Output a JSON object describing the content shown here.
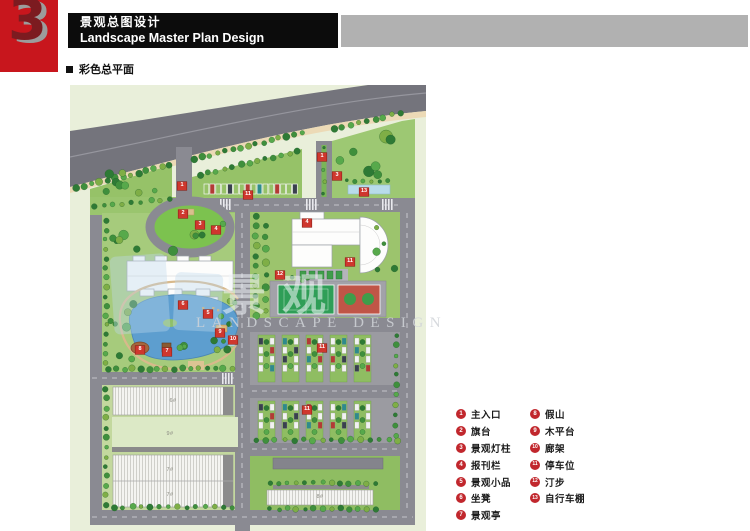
{
  "header": {
    "section_number": "3",
    "title_zh": "景观总图设计",
    "title_en": "Landscape Master Plan Design"
  },
  "subheader": {
    "label": "彩色总平面"
  },
  "watermark": {
    "text_zh": "景观",
    "text_en": "LANDSCAPE DESIGN"
  },
  "colors": {
    "accent_red": "#c8161d",
    "banner_black": "#0c0c0c",
    "bar_gray": "#b1b1b1",
    "marker_red": "#cf372e",
    "legend_red": "#c1272d"
  },
  "legend": {
    "columns": [
      {
        "items": [
          {
            "n": "1",
            "label": "主入口"
          },
          {
            "n": "2",
            "label": "旗台"
          },
          {
            "n": "3",
            "label": "景观灯柱"
          },
          {
            "n": "4",
            "label": "报刊栏"
          },
          {
            "n": "5",
            "label": "景观小品"
          },
          {
            "n": "6",
            "label": "坐凳"
          },
          {
            "n": "7",
            "label": "景观亭"
          }
        ]
      },
      {
        "items": [
          {
            "n": "8",
            "label": "假山"
          },
          {
            "n": "9",
            "label": "木平台"
          },
          {
            "n": "10",
            "label": "廊架"
          },
          {
            "n": "11",
            "label": "停车位"
          },
          {
            "n": "12",
            "label": "汀步"
          },
          {
            "n": "13",
            "label": "自行车棚"
          }
        ]
      }
    ]
  },
  "plan": {
    "markers": [
      {
        "n": "1",
        "x": 112,
        "y": 101
      },
      {
        "n": "1",
        "x": 252,
        "y": 72
      },
      {
        "n": "2",
        "x": 113,
        "y": 129
      },
      {
        "n": "3",
        "x": 130,
        "y": 140
      },
      {
        "n": "3",
        "x": 267,
        "y": 91
      },
      {
        "n": "4",
        "x": 146,
        "y": 145
      },
      {
        "n": "4",
        "x": 237,
        "y": 138
      },
      {
        "n": "5",
        "x": 138,
        "y": 229
      },
      {
        "n": "6",
        "x": 113,
        "y": 220
      },
      {
        "n": "7",
        "x": 97,
        "y": 267
      },
      {
        "n": "8",
        "x": 70,
        "y": 265
      },
      {
        "n": "9",
        "x": 150,
        "y": 248
      },
      {
        "n": "10",
        "x": 163,
        "y": 255
      },
      {
        "n": "11",
        "x": 178,
        "y": 110
      },
      {
        "n": "11",
        "x": 280,
        "y": 177
      },
      {
        "n": "11",
        "x": 252,
        "y": 263
      },
      {
        "n": "11",
        "x": 237,
        "y": 325
      },
      {
        "n": "12",
        "x": 210,
        "y": 190
      },
      {
        "n": "13",
        "x": 294,
        "y": 107
      }
    ],
    "building_labels": [
      {
        "text": "6#",
        "x": 103,
        "y": 316
      },
      {
        "text": "9#",
        "x": 100,
        "y": 349
      },
      {
        "text": "7#",
        "x": 100,
        "y": 385
      },
      {
        "text": "7#",
        "x": 100,
        "y": 410
      },
      {
        "text": "8#",
        "x": 250,
        "y": 412
      }
    ]
  }
}
